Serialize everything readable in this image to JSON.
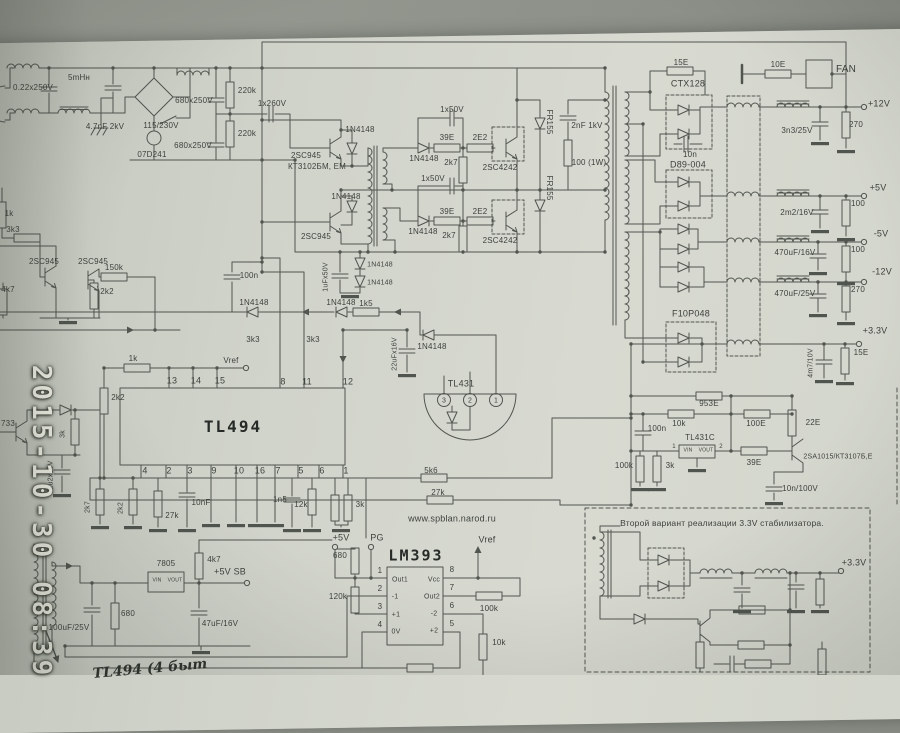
{
  "photo": {
    "timestamp": "2015-10-30 08:39",
    "handwritten_note": "TL494 (4 быт",
    "surface_color": "#90958c",
    "paper_color": "#d2d5cc",
    "ink_color": "#4d514c",
    "stamp_color": "#f4f4ea"
  },
  "schematic": {
    "website": "www.spblan.narod.ru",
    "variant_note": "Второй вариант реализации 3.3V стабилизатора.",
    "main_ics": [
      "TL494",
      "LM393",
      "TL431",
      "TL431C",
      "7805"
    ],
    "output_rails": [
      "+12V",
      "+5V",
      "-5V",
      "-12V",
      "+3.3V",
      "+5V SB"
    ],
    "signals": [
      "PG",
      "Vref",
      "FAN"
    ],
    "labels": [
      {
        "t": "0.22x250V",
        "x": 33,
        "y": 88
      },
      {
        "t": "5mHн",
        "x": 79,
        "y": 78
      },
      {
        "t": "4.7nF 2kV",
        "x": 105,
        "y": 127
      },
      {
        "t": "115/230V",
        "x": 161,
        "y": 126
      },
      {
        "t": "07D241",
        "x": 152,
        "y": 155
      },
      {
        "t": "680x250V",
        "x": 194,
        "y": 101
      },
      {
        "t": "680x250V",
        "x": 193,
        "y": 146
      },
      {
        "t": "220k",
        "x": 247,
        "y": 91
      },
      {
        "t": "220k",
        "x": 247,
        "y": 134
      },
      {
        "t": "1x260V",
        "x": 272,
        "y": 104
      },
      {
        "t": "2SC945",
        "x": 306,
        "y": 156
      },
      {
        "t": "КТ3102БМ, ЕМ",
        "x": 317,
        "y": 167
      },
      {
        "t": "1N4148",
        "x": 360,
        "y": 130
      },
      {
        "t": "1N4148",
        "x": 346,
        "y": 197
      },
      {
        "t": "2SC945",
        "x": 316,
        "y": 237
      },
      {
        "t": "1x50V",
        "x": 452,
        "y": 110
      },
      {
        "t": "39E",
        "x": 447,
        "y": 138
      },
      {
        "t": "2E2",
        "x": 480,
        "y": 138
      },
      {
        "t": "1N4148",
        "x": 424,
        "y": 159
      },
      {
        "t": "2k7",
        "x": 451,
        "y": 163
      },
      {
        "t": "2SC4242",
        "x": 500,
        "y": 168
      },
      {
        "t": "FR155",
        "x": 549,
        "y": 122,
        "r": 90
      },
      {
        "t": "1x50V",
        "x": 433,
        "y": 179
      },
      {
        "t": "39E",
        "x": 447,
        "y": 212
      },
      {
        "t": "2E2",
        "x": 480,
        "y": 212
      },
      {
        "t": "1N4148",
        "x": 423,
        "y": 232
      },
      {
        "t": "2k7",
        "x": 449,
        "y": 236
      },
      {
        "t": "2SC4242",
        "x": 500,
        "y": 241
      },
      {
        "t": "FR155",
        "x": 549,
        "y": 188,
        "r": 90
      },
      {
        "t": "2nF 1kV",
        "x": 587,
        "y": 126
      },
      {
        "t": "100 (1W)",
        "x": 589,
        "y": 163
      },
      {
        "t": "15E",
        "x": 681,
        "y": 63
      },
      {
        "t": "CTX128",
        "x": 688,
        "y": 84,
        "s": 9
      },
      {
        "t": "10n",
        "x": 690,
        "y": 155
      },
      {
        "t": "10E",
        "x": 778,
        "y": 65
      },
      {
        "t": "FAN",
        "x": 846,
        "y": 70,
        "s": 10
      },
      {
        "t": "+12V",
        "x": 879,
        "y": 104,
        "s": 9
      },
      {
        "t": "3n3/25V",
        "x": 797,
        "y": 131
      },
      {
        "t": "270",
        "x": 856,
        "y": 125
      },
      {
        "t": "D89-004",
        "x": 688,
        "y": 165,
        "s": 9
      },
      {
        "t": "+5V",
        "x": 878,
        "y": 188,
        "s": 9
      },
      {
        "t": "2m2/16V",
        "x": 797,
        "y": 213
      },
      {
        "t": "100",
        "x": 858,
        "y": 204
      },
      {
        "t": "-5V",
        "x": 881,
        "y": 234,
        "s": 9
      },
      {
        "t": "470uF/16V",
        "x": 795,
        "y": 253
      },
      {
        "t": "100",
        "x": 858,
        "y": 250
      },
      {
        "t": "-12V",
        "x": 882,
        "y": 272,
        "s": 9
      },
      {
        "t": "470uF/25V",
        "x": 795,
        "y": 294
      },
      {
        "t": "270",
        "x": 858,
        "y": 290
      },
      {
        "t": "F10P048",
        "x": 691,
        "y": 314,
        "s": 9
      },
      {
        "t": "+3.3V",
        "x": 875,
        "y": 331,
        "s": 9
      },
      {
        "t": "15E",
        "x": 861,
        "y": 353
      },
      {
        "t": "4m7/10V",
        "x": 811,
        "y": 363,
        "s": 7,
        "r": -90
      },
      {
        "t": "953E",
        "x": 709,
        "y": 404
      },
      {
        "t": "10k",
        "x": 679,
        "y": 424
      },
      {
        "t": "100E",
        "x": 756,
        "y": 424
      },
      {
        "t": "22E",
        "x": 813,
        "y": 423
      },
      {
        "t": "100n",
        "x": 657,
        "y": 429
      },
      {
        "t": "TL431C",
        "x": 700,
        "y": 438
      },
      {
        "t": "VIN",
        "x": 688,
        "y": 451,
        "s": 5
      },
      {
        "t": "VOUT",
        "x": 706,
        "y": 451,
        "s": 5
      },
      {
        "t": "1",
        "x": 674,
        "y": 447,
        "s": 6
      },
      {
        "t": "2",
        "x": 721,
        "y": 447,
        "s": 6
      },
      {
        "t": "39E",
        "x": 754,
        "y": 463
      },
      {
        "t": "2SA1015/КТ3107Б,Е",
        "x": 838,
        "y": 457,
        "s": 7
      },
      {
        "t": "100k",
        "x": 624,
        "y": 466
      },
      {
        "t": "3k",
        "x": 670,
        "y": 466
      },
      {
        "t": "10n/100V",
        "x": 800,
        "y": 489
      },
      {
        "t": "Второй вариант реализации 3.3V стабилизатора.",
        "x": 722,
        "y": 523,
        "s": 8.5
      },
      {
        "t": "+3.3V",
        "x": 854,
        "y": 563,
        "s": 9
      },
      {
        "t": "TL494",
        "x": 233,
        "y": 427,
        "s": 16,
        "w": 1
      },
      {
        "t": "13",
        "x": 172,
        "y": 381,
        "s": 9
      },
      {
        "t": "14",
        "x": 196,
        "y": 381,
        "s": 9
      },
      {
        "t": "15",
        "x": 220,
        "y": 381,
        "s": 9
      },
      {
        "t": "8",
        "x": 283,
        "y": 382,
        "s": 9
      },
      {
        "t": "11",
        "x": 307,
        "y": 382,
        "s": 9
      },
      {
        "t": "12",
        "x": 348,
        "y": 382,
        "s": 9
      },
      {
        "t": "4",
        "x": 145,
        "y": 471,
        "s": 9
      },
      {
        "t": "2",
        "x": 169,
        "y": 471,
        "s": 9
      },
      {
        "t": "3",
        "x": 190,
        "y": 471,
        "s": 9
      },
      {
        "t": "9",
        "x": 214,
        "y": 471,
        "s": 9
      },
      {
        "t": "10",
        "x": 239,
        "y": 471,
        "s": 9
      },
      {
        "t": "16",
        "x": 260,
        "y": 471,
        "s": 9
      },
      {
        "t": "7",
        "x": 278,
        "y": 471,
        "s": 9
      },
      {
        "t": "5",
        "x": 301,
        "y": 471,
        "s": 9
      },
      {
        "t": "6",
        "x": 322,
        "y": 471,
        "s": 9
      },
      {
        "t": "1",
        "x": 346,
        "y": 471,
        "s": 9
      },
      {
        "t": "1k",
        "x": 133,
        "y": 359
      },
      {
        "t": "Vref",
        "x": 231,
        "y": 361
      },
      {
        "t": "1N4148",
        "x": 254,
        "y": 303
      },
      {
        "t": "1N4148",
        "x": 341,
        "y": 303
      },
      {
        "t": "1k5",
        "x": 366,
        "y": 304
      },
      {
        "t": "3k3",
        "x": 253,
        "y": 340
      },
      {
        "t": "3k3",
        "x": 313,
        "y": 340
      },
      {
        "t": "2k2",
        "x": 118,
        "y": 398
      },
      {
        "t": "22uFx16V",
        "x": 395,
        "y": 354,
        "s": 7,
        "r": -90
      },
      {
        "t": "1N4148",
        "x": 432,
        "y": 347
      },
      {
        "t": "100n",
        "x": 249,
        "y": 276
      },
      {
        "t": "1uFx50V",
        "x": 326,
        "y": 277,
        "s": 7,
        "r": -90
      },
      {
        "t": "1N4148",
        "x": 380,
        "y": 265,
        "s": 7
      },
      {
        "t": "1N4148",
        "x": 380,
        "y": 283,
        "s": 7
      },
      {
        "t": "2k7",
        "x": 88,
        "y": 507,
        "s": 7,
        "r": -90
      },
      {
        "t": "2k2",
        "x": 121,
        "y": 508,
        "s": 7,
        "r": -90
      },
      {
        "t": "27k",
        "x": 172,
        "y": 516
      },
      {
        "t": "10nF",
        "x": 201,
        "y": 503
      },
      {
        "t": "1n5",
        "x": 280,
        "y": 500
      },
      {
        "t": "12k",
        "x": 301,
        "y": 505
      },
      {
        "t": "3k",
        "x": 360,
        "y": 505
      },
      {
        "t": "TL431",
        "x": 461,
        "y": 384,
        "s": 9
      },
      {
        "t": "3",
        "x": 444,
        "y": 401,
        "s": 7
      },
      {
        "t": "2",
        "x": 470,
        "y": 401,
        "s": 7
      },
      {
        "t": "1",
        "x": 496,
        "y": 401,
        "s": 7
      },
      {
        "t": "5k6",
        "x": 431,
        "y": 471
      },
      {
        "t": "27k",
        "x": 438,
        "y": 493
      },
      {
        "t": "www.spblan.narod.ru",
        "x": 452,
        "y": 519,
        "s": 9
      },
      {
        "t": "+5V",
        "x": 341,
        "y": 538,
        "s": 9
      },
      {
        "t": "PG",
        "x": 377,
        "y": 538,
        "s": 9
      },
      {
        "t": "LM393",
        "x": 416,
        "y": 556,
        "s": 15,
        "w": 1
      },
      {
        "t": "Vref",
        "x": 487,
        "y": 540,
        "s": 9
      },
      {
        "t": "680",
        "x": 340,
        "y": 556
      },
      {
        "t": "120k",
        "x": 338,
        "y": 597
      },
      {
        "t": "1",
        "x": 380,
        "y": 571,
        "s": 8
      },
      {
        "t": "Out1",
        "x": 400,
        "y": 580,
        "s": 7
      },
      {
        "t": "2",
        "x": 380,
        "y": 589,
        "s": 8
      },
      {
        "t": "-1",
        "x": 395,
        "y": 597,
        "s": 7
      },
      {
        "t": "3",
        "x": 380,
        "y": 607,
        "s": 8
      },
      {
        "t": "+1",
        "x": 396,
        "y": 615,
        "s": 7
      },
      {
        "t": "4",
        "x": 380,
        "y": 625,
        "s": 8
      },
      {
        "t": "0V",
        "x": 396,
        "y": 632,
        "s": 7
      },
      {
        "t": "8",
        "x": 452,
        "y": 570,
        "s": 8
      },
      {
        "t": "Vcc",
        "x": 434,
        "y": 580,
        "s": 7
      },
      {
        "t": "7",
        "x": 452,
        "y": 588,
        "s": 8
      },
      {
        "t": "Out2",
        "x": 432,
        "y": 597,
        "s": 7
      },
      {
        "t": "6",
        "x": 452,
        "y": 606,
        "s": 8
      },
      {
        "t": "-2",
        "x": 434,
        "y": 614,
        "s": 7
      },
      {
        "t": "5",
        "x": 452,
        "y": 624,
        "s": 8
      },
      {
        "t": "+2",
        "x": 434,
        "y": 631,
        "s": 7
      },
      {
        "t": "100k",
        "x": 489,
        "y": 609
      },
      {
        "t": "10k",
        "x": 499,
        "y": 643
      },
      {
        "t": "7805",
        "x": 166,
        "y": 564
      },
      {
        "t": "VIN",
        "x": 157,
        "y": 581,
        "s": 5
      },
      {
        "t": "VOUT",
        "x": 175,
        "y": 581,
        "s": 5
      },
      {
        "t": "4k7",
        "x": 214,
        "y": 560
      },
      {
        "t": "+5V SB",
        "x": 230,
        "y": 572,
        "s": 9
      },
      {
        "t": "680",
        "x": 128,
        "y": 614
      },
      {
        "t": "47uF/16V",
        "x": 220,
        "y": 624
      },
      {
        "t": "100uF/25V",
        "x": 69,
        "y": 628
      },
      {
        "t": "733",
        "x": 8,
        "y": 424
      },
      {
        "t": "3k",
        "x": 63,
        "y": 434,
        "s": 7,
        "r": -90
      },
      {
        "t": "2u2x50V",
        "x": 51,
        "y": 475,
        "s": 7,
        "r": -90
      },
      {
        "t": "1k",
        "x": 9,
        "y": 214
      },
      {
        "t": "3k3",
        "x": 13,
        "y": 230
      },
      {
        "t": "2SC945",
        "x": 44,
        "y": 262
      },
      {
        "t": "2SC945",
        "x": 93,
        "y": 262
      },
      {
        "t": "150k",
        "x": 114,
        "y": 268
      },
      {
        "t": "4k7",
        "x": 8,
        "y": 290
      },
      {
        "t": "2k2",
        "x": 107,
        "y": 292
      }
    ]
  }
}
